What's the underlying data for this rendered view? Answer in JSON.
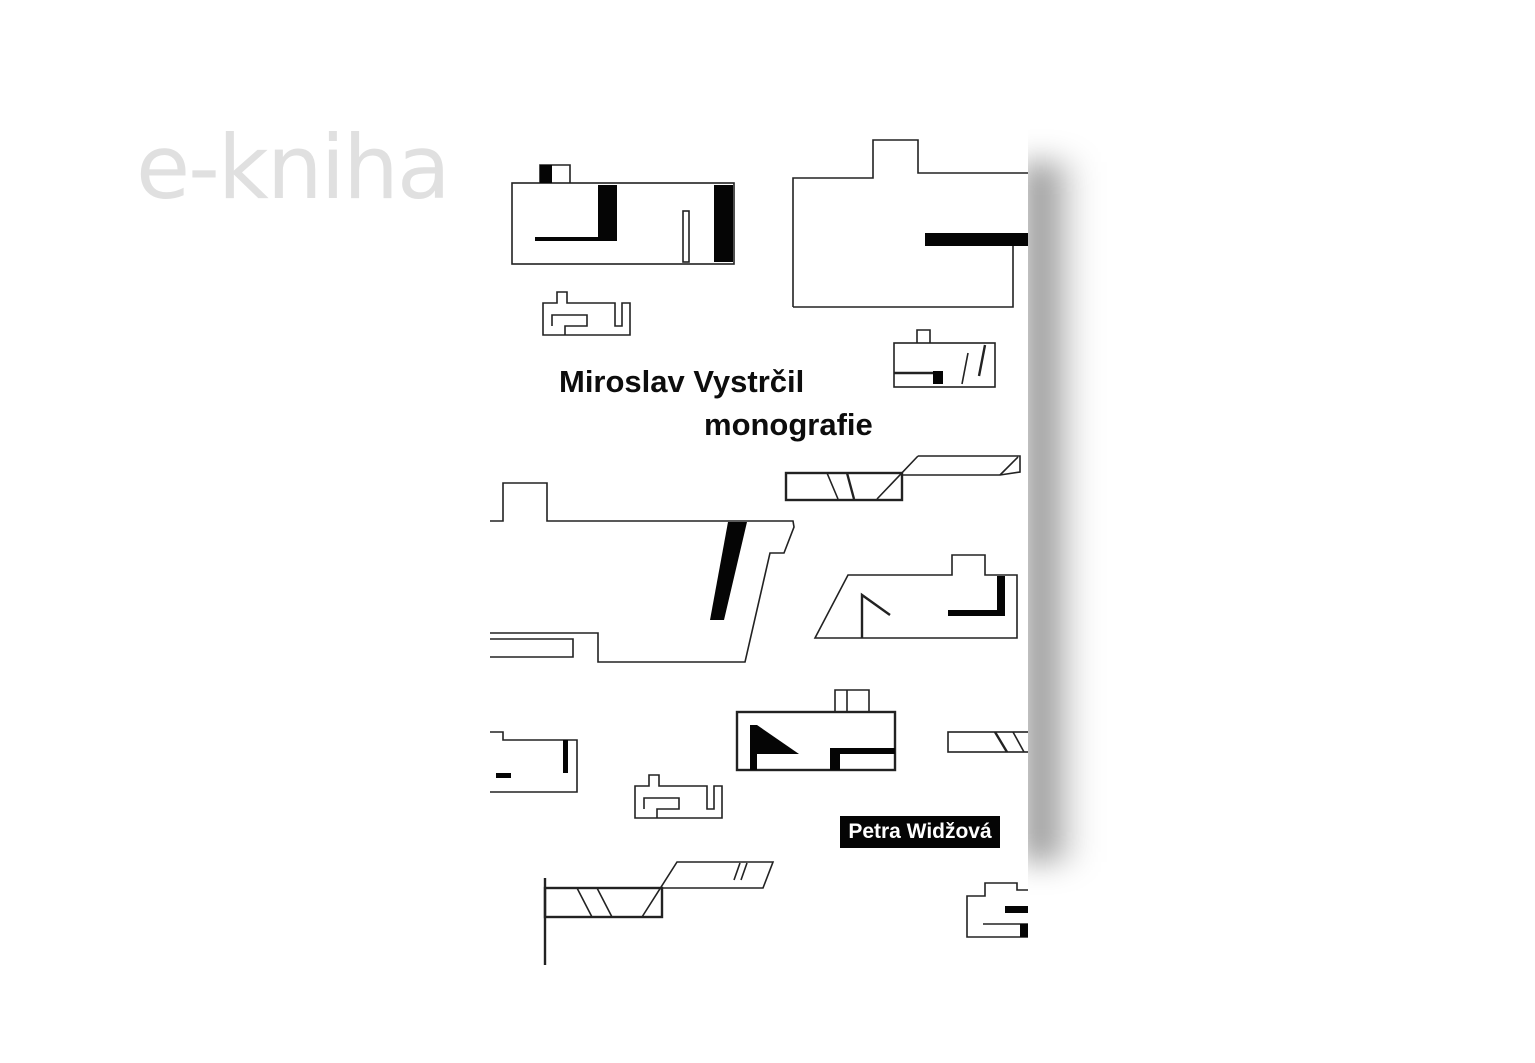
{
  "watermark": {
    "text": "e-kniha"
  },
  "book": {
    "title_line1": "Miroslav Vystrčil",
    "title_line2": "monografie",
    "author": "Petra Widžová"
  },
  "artwork": {
    "style": "abstract black-and-white architectural floor-plan sketches",
    "sketch_count": 13,
    "sketches": [
      "floorplan-sketch-top-left",
      "floorplan-sketch-top-right",
      "maze-sketch-upper",
      "flag-box-sketch",
      "large-plan-sketch",
      "slatted-bars-sketch-upper",
      "trapezoid-plan-sketch",
      "maze-sketch-lower",
      "flag-box-sketch-lower",
      "corner-plan-sketch",
      "slatted-bars-sketch-lower",
      "slatted-bar-right-sketch",
      "stepped-plan-sketch-bottom-right"
    ]
  },
  "colors": {
    "page": "#ffffff",
    "cover": "#ffffff",
    "watermark": "#e0e0e0",
    "ink": "#222222",
    "badge-bg": "#050505",
    "badge-text": "#ffffff"
  }
}
